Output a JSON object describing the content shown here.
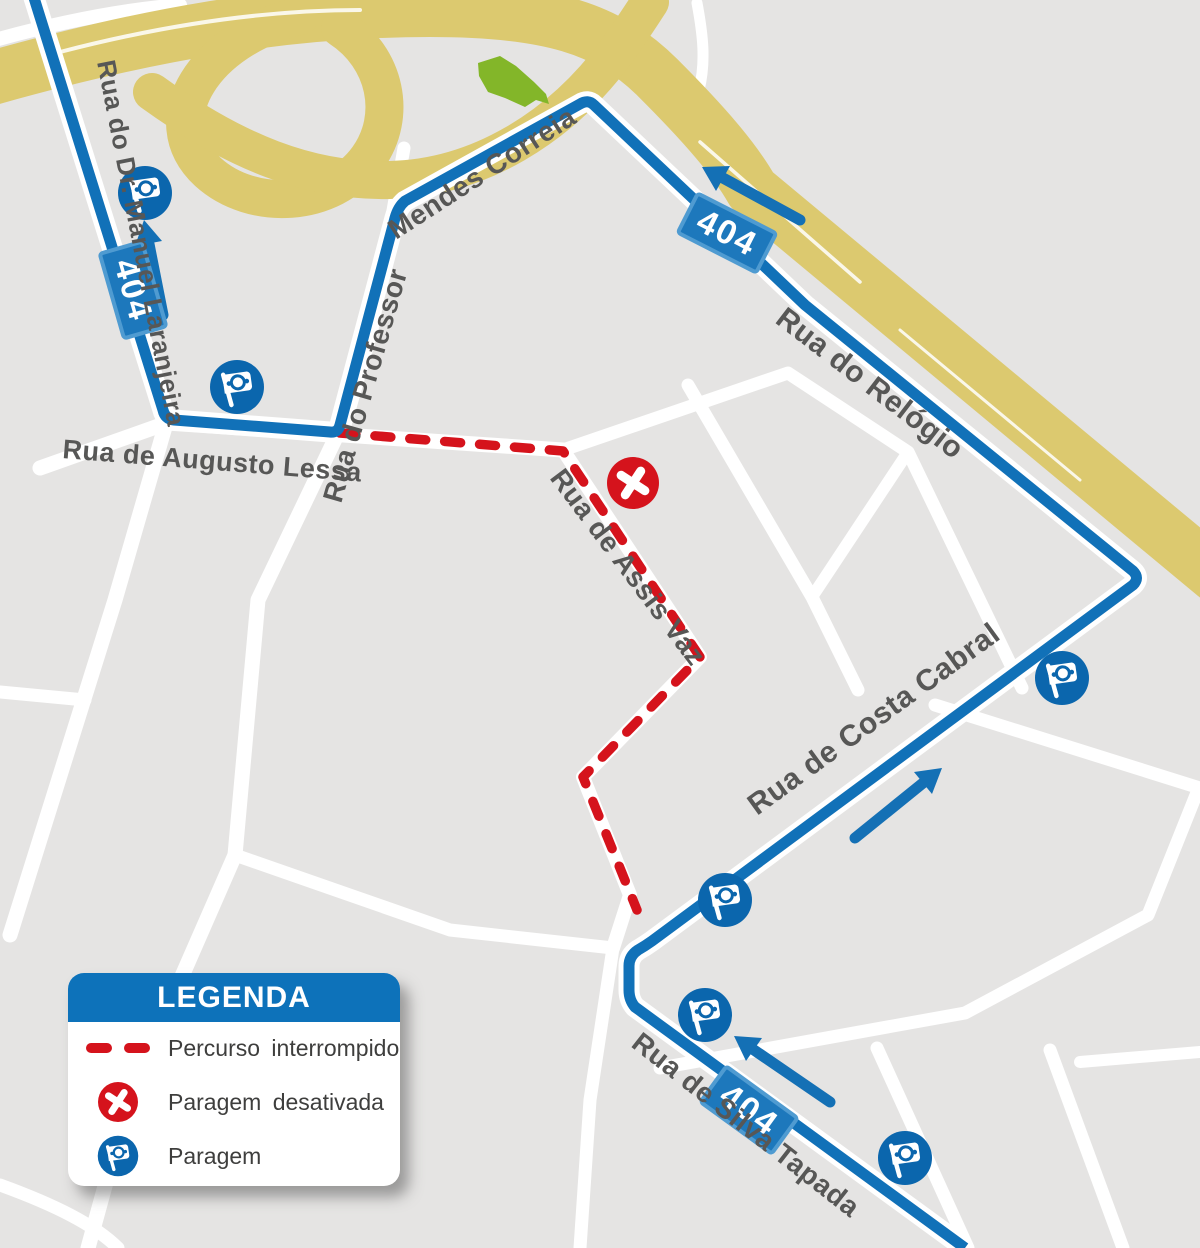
{
  "map": {
    "route_number": "404",
    "street_labels": [
      {
        "text": "Rua do Dr. Manuel Laranjeira"
      },
      {
        "text": "Rua de Augusto Lessa"
      },
      {
        "text": "Rua do Professor"
      },
      {
        "text": "Mendes Correia"
      },
      {
        "text": "Rua do Relógio"
      },
      {
        "text": "Rua de Assis Vaz"
      },
      {
        "text": "Rua de Costa Cabral"
      },
      {
        "text": "Rua de Silva Tapada"
      }
    ],
    "badges": [
      {
        "label": "404"
      },
      {
        "label": "404"
      },
      {
        "label": "404"
      }
    ],
    "colors": {
      "route_blue": "#1171b8",
      "stop_blue": "#0b66ad",
      "detour_red": "#d5131c",
      "highway_gold": "#dcc96f",
      "green_area": "#83b629",
      "label_gray": "#575756"
    }
  },
  "legend": {
    "title": "LEGENDA",
    "items": [
      {
        "icon": "dashed-line",
        "label": "Percurso interrompido"
      },
      {
        "icon": "disabled-stop",
        "label": "Paragem desativada"
      },
      {
        "icon": "stop",
        "label": "Paragem"
      }
    ]
  }
}
